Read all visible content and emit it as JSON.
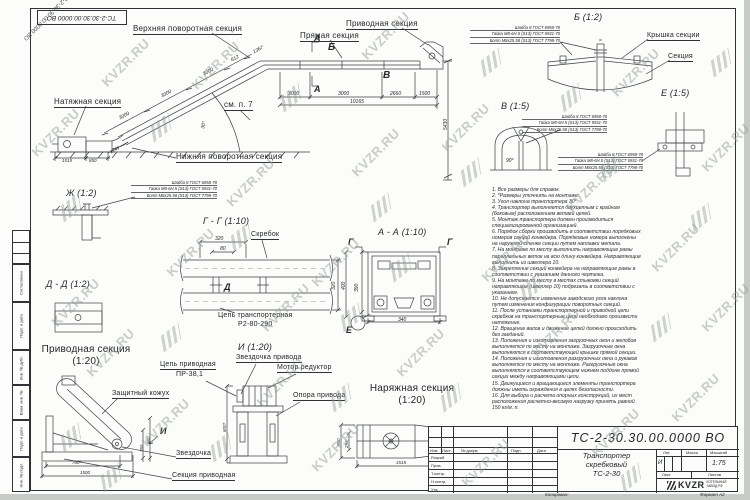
{
  "watermark": {
    "text": "KVZR.RU"
  },
  "corner_stamp": "ТС-2-30.30.00.0000 ВО",
  "main_view": {
    "labels": {
      "upper_turn": "Верхняя поворотная секция",
      "straight": "Прямая секция",
      "drive": "Приводная секция",
      "tension": "Натяжная секция",
      "see_note": "см. п. 7",
      "lower_turn": "Нижняя поворотная секция"
    },
    "marks": {
      "a": "А",
      "b": "Б",
      "v": "В"
    },
    "dims": {
      "d1367": "1367",
      "i612": "612",
      "i3000a": "3000",
      "i3000b": "3000",
      "i3000c": "3000",
      "d3000a": "3000",
      "d3000b": "3000",
      "d2660": "2660",
      "d1500": "1500",
      "total": "10165",
      "height": "5430",
      "b1515": "1515",
      "b850": "850",
      "b1249": "1249",
      "angle": "30°"
    }
  },
  "gost_note": {
    "line1": "Шайба 8 ГОСТ 6958-78",
    "line2": "Гайка М8-6Н.5 (S13) ГОСТ 5931-70",
    "line3": "Болт М8х25.58 (S13) ГОСТ 7798-70"
  },
  "details": {
    "zh": {
      "title": "Ж (1:2)"
    },
    "gg": {
      "title": "Г - Г (1:10)",
      "scraper": "Скребок",
      "chain_l1": "Цепь транспортерная",
      "chain_l2": "Р2-80-290",
      "d320t": "320",
      "d80": "80",
      "d320r": "320",
      "d400": "400",
      "mark_d": "Д"
    },
    "dd": {
      "title": "Д - Д (1:2)"
    },
    "aa": {
      "title": "А - А (1:10)",
      "d390": "390",
      "d340": "340",
      "mark_g1": "Г",
      "mark_g2": "Г",
      "mark_e": "Е"
    },
    "b": {
      "title": "Б (1:2)",
      "cover": "Крышка секции",
      "section": "Секция"
    },
    "v": {
      "title": "В (1:5)",
      "angle": "90°"
    },
    "e": {
      "title": "Е (1:5)"
    },
    "drive_sec": {
      "title_l1": "Приводная секция",
      "title_l2": "(1:20)",
      "chain_l1": "Цепь приводная",
      "chain_l2": "ПР-38,1",
      "cover": "Защитный кожух",
      "sprocket": "Звездочка",
      "section": "Секция приводная",
      "d780": "780*",
      "d1500": "1500",
      "d560": "560",
      "d765": "765",
      "mark_i": "И"
    },
    "i_view": {
      "title": "И (1:20)",
      "sprocket": "Звездочка привода",
      "motor": "Мотор редуктор",
      "support": "Опора привода",
      "d600": "600*"
    },
    "tension_sec": {
      "title_l1": "Наряжная секция",
      "title_l2": "(1:20)",
      "d560": "560",
      "d295": "295",
      "d1515": "1515"
    }
  },
  "notes": [
    "1. Все размеры для справок.",
    "2. *Размеры уточнить на монтаже.",
    "3. Угол наклона транспортера 30°.",
    "4. Транспортер выполняется двухцепным с крайним (боковым) расположением ветвей цепей.",
    "5. Монтаж транспортера должен производиться специализированной организацией.",
    "6. Порядок сборки производить в соответствии порядковых номеров секций конвейера. Порядковые номера выполнены на наружной стенке секции путем наплавки метала.",
    "7. На монтаже по месту выполнить направляющие рамы параллельных веток на всю длину конвейера. Направляющие выполнить из швеллера 10.",
    "8. Закрепление секций конвейера на направляющие рамы в соответствии с указанием данного чертежа.",
    "9. На монтаже по месту в местах стыковки секций направляющие (швеллер 10) подрезать в соответствии с указанием.",
    "10. Не допускается изменение заводского угла наклона путем изменения конфигурации поворотных секций.",
    "11. После установки транспортерной и приводной цепи скребков на транспортерные цепи необходимо произвести натяжение.",
    "12. Вращение валов и движение цепей должно происходить без заеданий.",
    "13. Положения и изготовления загрузочных окон и желобов выполняется по месту на монтаже. Загрузочные окна выполняются в соответствующей крышке прямой секции.",
    "14. Положения и изготовления разгрузочных окна и рукавов выполняется по месту на монтаже. Разгрузочные окна выполняются в соответствующем нижнем поддоне прямой секции между направляющими цепи.",
    "15. Движущиеся и вращающиеся элементы транспортера должны иметь ограждения в целях безопасности.",
    "16. Для выбора и расчета опорных конструкций, их мест расположения расчетно-весовую нагрузку принять равной 150 кг/м. п."
  ],
  "form_strip": {
    "labels": [
      "Согласовано",
      "Подп. и дата",
      "Инв. № дубл.",
      "Взам. инв. №",
      "Подп. и дата",
      "Инв. № подл."
    ]
  },
  "title_block": {
    "doc_number": "ТС-2-30.30.00.0000 ВО",
    "name_l1": "Транспортер",
    "name_l2": "скребковый",
    "name_l3": "ТС-2-30",
    "col_lit": "Лит.",
    "col_mass": "Масса",
    "col_scale": "Масштаб",
    "lit_val": "И",
    "scale_val": "1:75",
    "sheet_label": "Лист",
    "sheets_label": "Листов",
    "rows": {
      "izm": "Изм",
      "list": "Лист",
      "doc": "№ докум.",
      "podp": "Подп.",
      "data": "Дата",
      "razrab": "Разраб.",
      "prov": "Пров.",
      "tkontr": "Т.контр.",
      "nkontr": "Н.контр.",
      "utv": "Утв."
    },
    "logo": "KVZR",
    "logo_sub_l1": "КОТЕЛЬНЫЙ",
    "logo_sub_l2": "ЗАВОД РФ"
  },
  "margins": {
    "copied": "Копировал:",
    "format": "Формат А2"
  }
}
